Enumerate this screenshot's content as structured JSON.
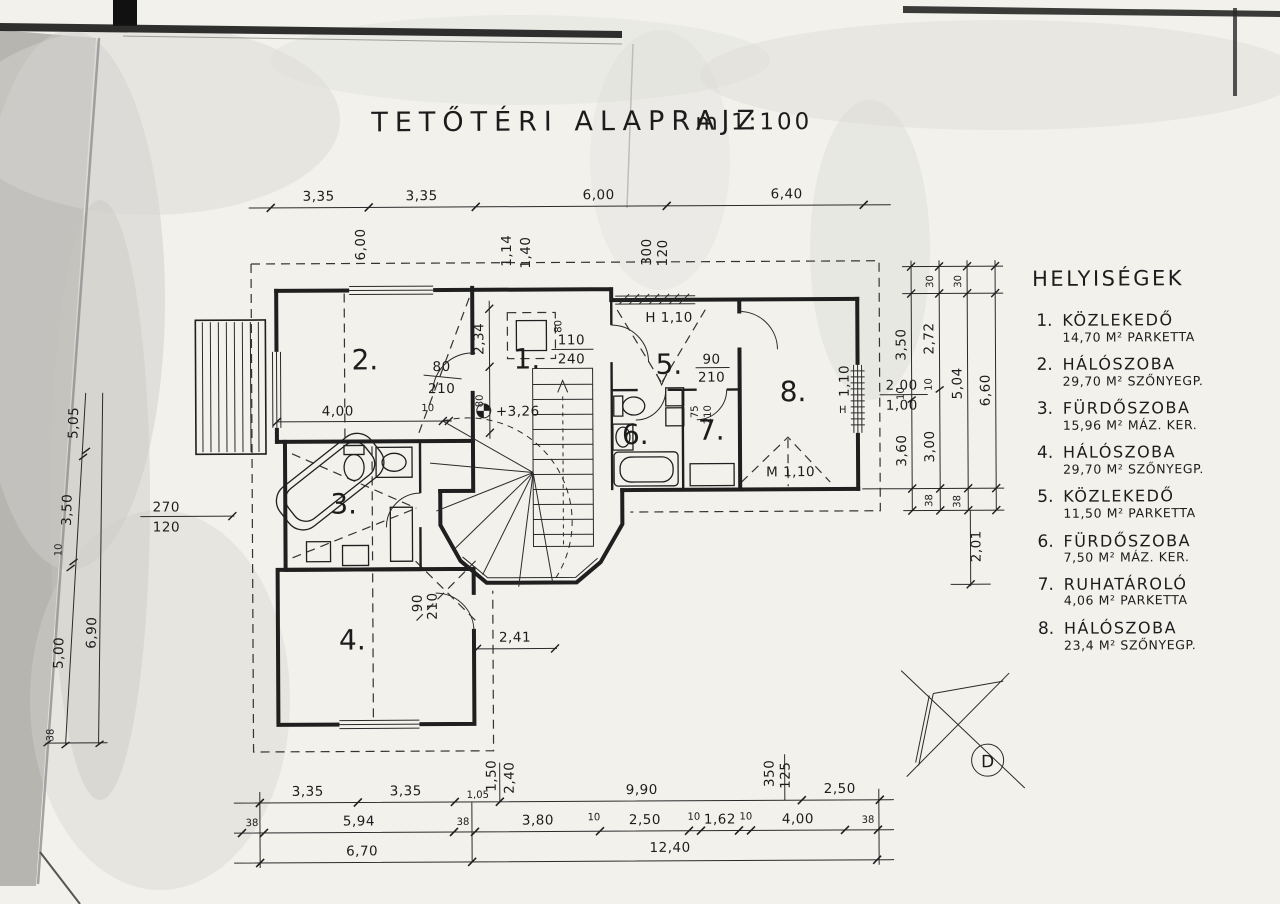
{
  "sheet": {
    "title": "TETŐTÉRI ALAPRAJZ",
    "scale": "m 1:100"
  },
  "legend": {
    "title": "HELYISÉGEK",
    "items": [
      {
        "num": "1.",
        "name": "KÖZLEKEDŐ",
        "detail": "14,70 M² PARKETTA"
      },
      {
        "num": "2.",
        "name": "HÁLÓSZOBA",
        "detail": "29,70 M² SZŐNYEGP."
      },
      {
        "num": "3.",
        "name": "FÜRDŐSZOBA",
        "detail": "15,96 M² MÁZ. KER."
      },
      {
        "num": "4.",
        "name": "HÁLÓSZOBA",
        "detail": "29,70 M² SZŐNYEGP."
      },
      {
        "num": "5.",
        "name": "KÖZLEKEDŐ",
        "detail": "11,50 M² PARKETTA"
      },
      {
        "num": "6.",
        "name": "FÜRDŐSZOBA",
        "detail": "7,50 M² MÁZ. KER."
      },
      {
        "num": "7.",
        "name": "RUHATÁROLÓ",
        "detail": "4,06 M² PARKETTA"
      },
      {
        "num": "8.",
        "name": "HÁLÓSZOBA",
        "detail": "23,4 M² SZŐNYEGP."
      }
    ]
  },
  "rooms": {
    "n1": "1.",
    "n2": "2.",
    "n3": "3.",
    "n4": "4.",
    "n5": "5.",
    "n6": "6.",
    "n7": "7.",
    "n8": "8."
  },
  "dims": {
    "top": {
      "segs": [
        "3,35",
        "3,35",
        "6,00",
        "6,40"
      ],
      "rot": "6,00",
      "pair1": [
        "1,14",
        "1,40"
      ],
      "pair2": [
        "300",
        "120"
      ]
    },
    "b1": {
      "segs": [
        "3,35",
        "3,35",
        "1,05",
        "9,90",
        "2,50"
      ],
      "pair1": [
        "1,50",
        "2,40"
      ],
      "pair2": [
        "350",
        "125"
      ]
    },
    "b2": [
      "38",
      "5,94",
      "38",
      "3,80",
      "10",
      "2,50",
      "10",
      "1,62",
      "10",
      "4,00",
      "38"
    ],
    "b3": [
      "6,70",
      "12,40"
    ],
    "left": {
      "segs": [
        "5,05",
        "3,50",
        "10",
        "5,00"
      ],
      "total": "6,90",
      "end": "38",
      "win": [
        "270",
        "120"
      ]
    },
    "right": {
      "tops": [
        "30",
        "30"
      ],
      "a": [
        "3,50",
        "10",
        "3,60"
      ],
      "b": [
        "2,72",
        "10",
        "3,00",
        "38"
      ],
      "c": [
        "5,04",
        "38"
      ],
      "d": "6,60",
      "bottom": "2,01",
      "win": [
        "2,00",
        "1,00"
      ],
      "winh": "1,10",
      "hmark": "H"
    }
  },
  "plan": {
    "level": "+3,26",
    "r1a": "2,34",
    "r1b": "80",
    "r1rot": "80",
    "pair": [
      "110",
      "240"
    ],
    "r2dim": "4,00",
    "r2s": "10",
    "r4dim": "2,41",
    "d2": [
      "80",
      "210"
    ],
    "d4": [
      "90",
      "210"
    ],
    "d7": [
      "75",
      "210"
    ],
    "d8": [
      "90",
      "210"
    ],
    "hA": "H 1,10",
    "hB": "M 1,10"
  },
  "compass": {
    "south": "D"
  }
}
